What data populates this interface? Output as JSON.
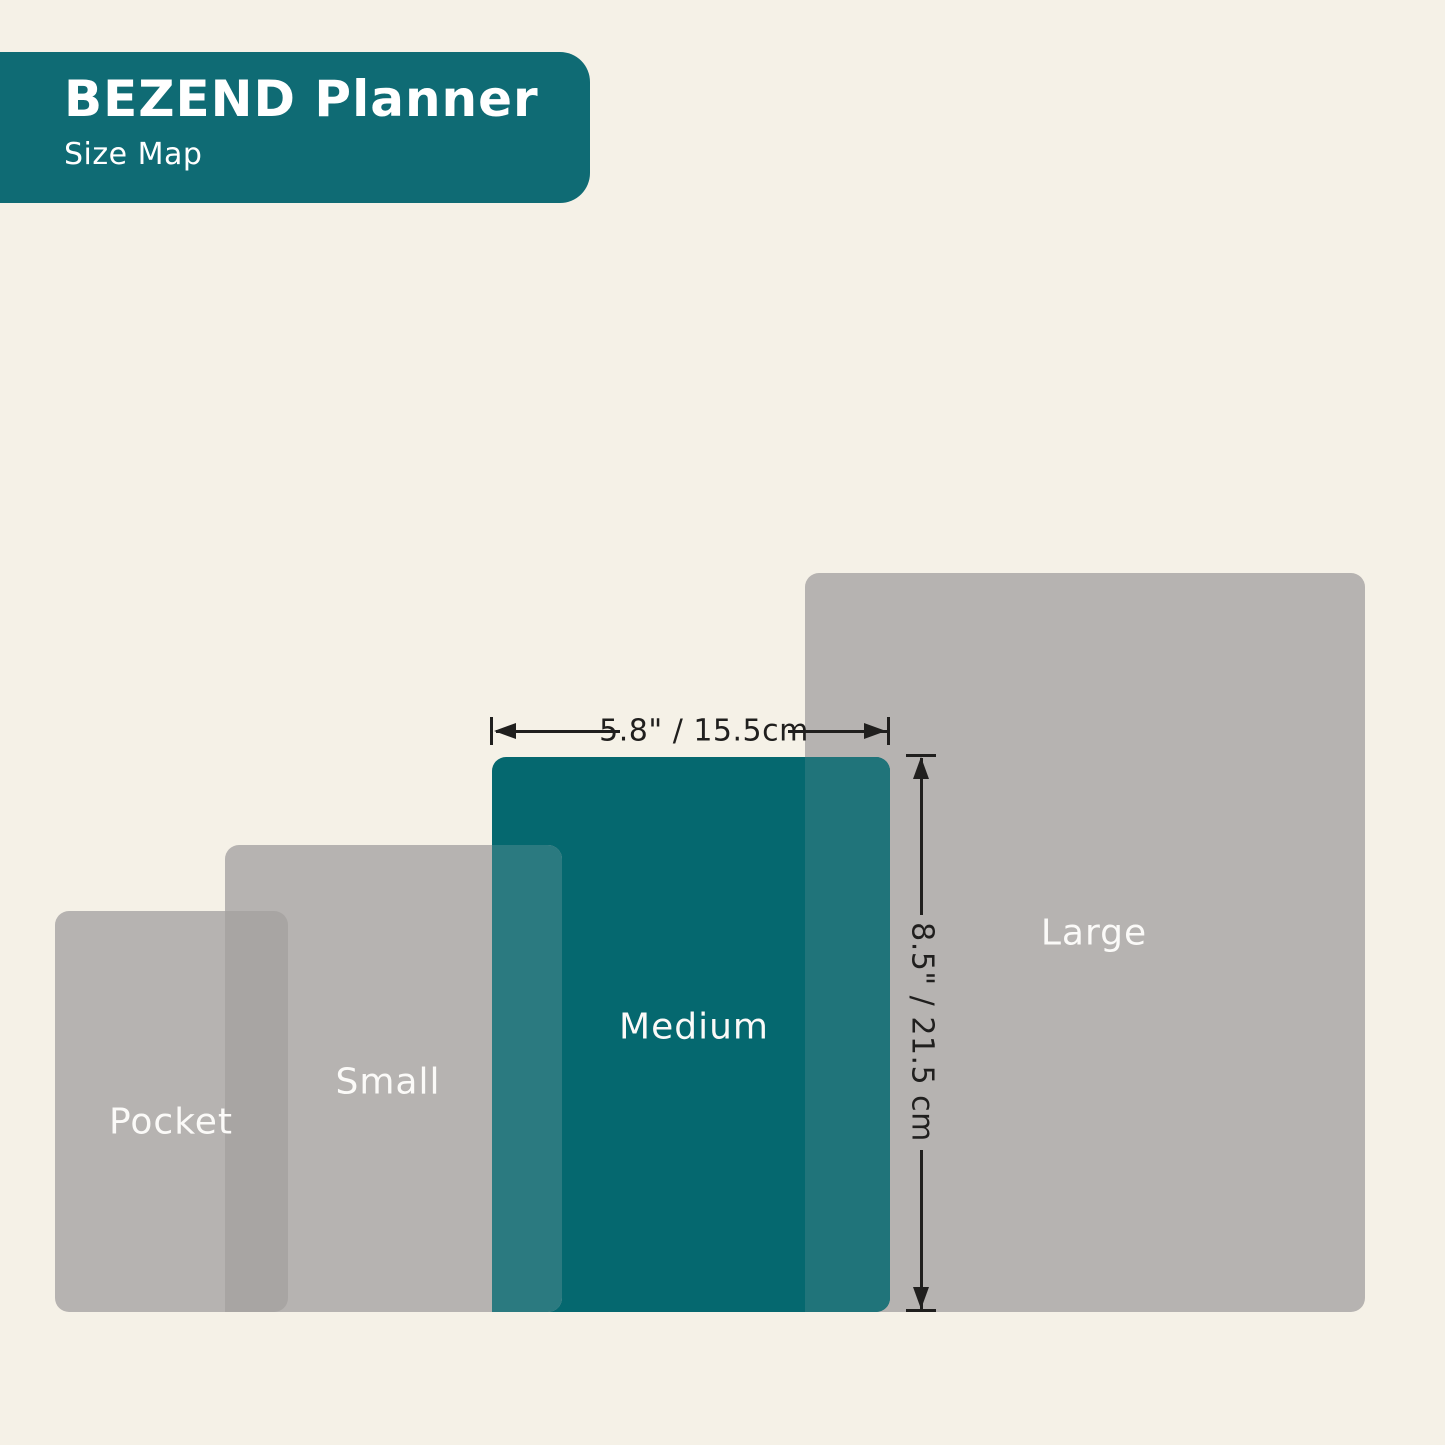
{
  "header": {
    "title": "BEZEND Planner",
    "subtitle": "Size Map",
    "background_color": "#0f6b74",
    "text_color": "#ffffff"
  },
  "canvas": {
    "background_color": "#f5f1e7"
  },
  "sizes": [
    {
      "label": "Pocket",
      "highlighted": false,
      "fill_color": "#b6b3b1",
      "label_color": "#fbfaf8"
    },
    {
      "label": "Small",
      "highlighted": false,
      "fill_color": "#b6b3b1",
      "label_color": "#fbfaf8"
    },
    {
      "label": "Medium",
      "highlighted": true,
      "fill_color": "#05686f",
      "label_color": "#fbfaf8"
    },
    {
      "label": "Large",
      "highlighted": false,
      "fill_color": "#b6b3b1",
      "label_color": "#fbfaf8"
    }
  ],
  "overlap_colors": {
    "pocket_small": "#a8a5a3",
    "small_medium": "#2b7a80",
    "medium_large": "#20747a"
  },
  "dimensions": {
    "applies_to": "Medium",
    "width_label": "5.8\" / 15.5cm",
    "height_label": "8.5\" / 21.5 cm",
    "line_color": "#201f1e"
  }
}
